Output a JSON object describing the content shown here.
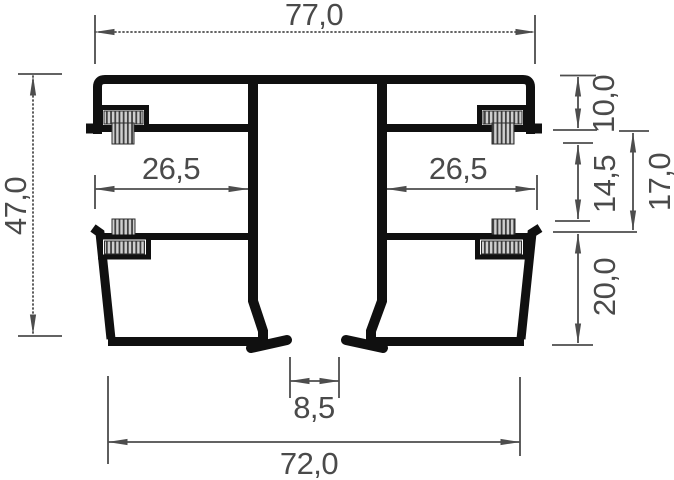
{
  "drawing": {
    "labels": {
      "width_top": "77,0",
      "height_overall": "47,0",
      "recess_width_left": "26,5",
      "recess_width_right": "26,5",
      "head_height": "10,0",
      "recess_inner_height": "14,5",
      "recess_outer_height": "17,0",
      "base_height": "20,0",
      "foot_gap": "8,5",
      "width_bottom": "72,0"
    },
    "colors": {
      "profile_line": "#101010",
      "dimension_line": "#4d4d4d",
      "dimension_text": "#4a4a4a",
      "brush_fill": "#cfcfcf",
      "brush_bristle": "#3a3a3a",
      "background": "#ffffff"
    }
  }
}
